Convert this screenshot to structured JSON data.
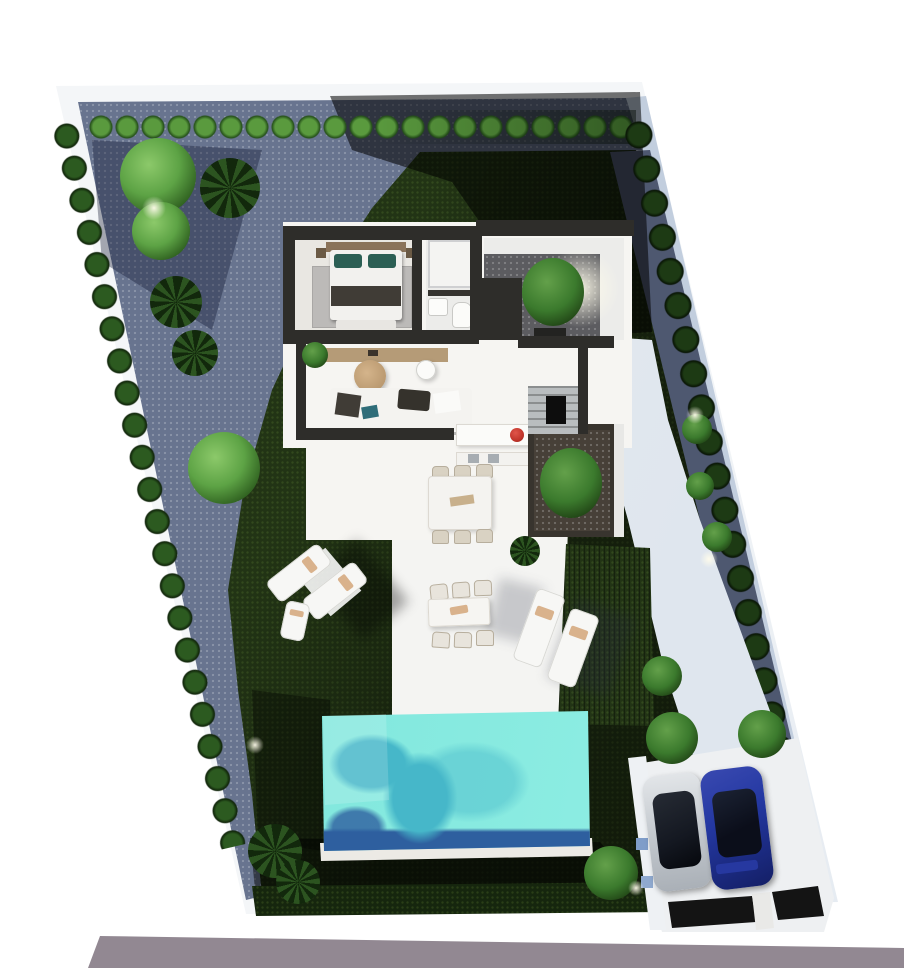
{
  "scene": {
    "title": "Aerial 3D site plan render of a modern villa plot",
    "type": "architectural-render",
    "no_text_visible": true
  },
  "colors": {
    "lawn": "#223415",
    "lawndark": "#0d1808",
    "hedgestrip": "#16260e",
    "gravel": "#68748f",
    "graveldark": "#4e5870",
    "wall": "#f1f4f7",
    "wallshade": "#c2cede",
    "terrace": "#f4f4f2",
    "pathwhite": "#edeff2",
    "pool": "#85e9df",
    "poollight": "#97f2e7",
    "poolmottle": "#46b7c9",
    "pooldeep": "#2e5f9f",
    "coping": "#eceae5",
    "roof": "#2e2d2a",
    "floor": "#f6f5f2",
    "floordim": "#e9e7e2",
    "rug": "#bcbab8",
    "wood": "#b59b77",
    "wooddark": "#8a735a",
    "tealpillow": "#2c5f54",
    "sofateal": "#2f6d79",
    "sofawhite": "#f4f3f0",
    "cushiondark": "#403c36",
    "redpot": "#c1352b",
    "chairbeige": "#d9d2c3",
    "courtyardgravel": "#5c5c60",
    "plantersoil": "#474038",
    "stair": "#b9bdbf",
    "driveway": "#caced2",
    "drivewaylight": "#eef0f2",
    "carsilver": "#c9ced3",
    "carsilverlight": "#e2e5e8",
    "carblue": "#2438a2",
    "carbluedark": "#141f66",
    "glass": "#141821",
    "gate": "#141414",
    "sidewalk": "#d9d2ca",
    "road": "#9d939b",
    "treebright": "#5da345",
    "treemid": "#3b7a2d"
  },
  "objects": [
    {
      "name": "plot-boundary-wall",
      "description": "white perimeter wall, skewed parallelogram plot"
    },
    {
      "name": "lawn",
      "description": "dark green grass covering most of the garden"
    },
    {
      "name": "gravel-garden",
      "description": "blue-grey gravel zone along top-left with trees and palms"
    },
    {
      "name": "hedge-rows",
      "description": "rows of round clipped shrubs along all boundaries"
    },
    {
      "name": "villa",
      "description": "single-storey white villa with flat dark roofline"
    },
    {
      "name": "bedroom",
      "description": "double bed, teal pillows, grey rug, bedside tables"
    },
    {
      "name": "bathroom",
      "description": "shower, washbasin and toilet"
    },
    {
      "name": "entry-courtyard",
      "description": "gravel patio with tree and warm uplight"
    },
    {
      "name": "living-room",
      "description": "white sofa, round wooden coffee table, floor lamp, sideboard"
    },
    {
      "name": "kitchen",
      "description": "island with red pot, counter with twin sinks"
    },
    {
      "name": "dining-table-indoor",
      "description": "white table with six beige chairs"
    },
    {
      "name": "staircase",
      "description": "grey stairs beside hallway"
    },
    {
      "name": "planter-bed",
      "description": "dark soil planter with large shrub beside kitchen"
    },
    {
      "name": "terrace",
      "description": "white paved terrace with loungers and outdoor dining set"
    },
    {
      "name": "sun-loungers",
      "description": "two pairs of white sun loungers"
    },
    {
      "name": "pool",
      "description": "turquoise rectangular swimming pool with dark deep-end edge"
    },
    {
      "name": "driveway",
      "description": "concrete parking pad with two parked cars"
    },
    {
      "name": "car-silver",
      "description": "silver car with dark glass roof"
    },
    {
      "name": "car-blue",
      "description": "blue car with dark glass roof"
    },
    {
      "name": "gate",
      "description": "dark entrance gate strips at the street"
    },
    {
      "name": "sidewalk",
      "description": "beige paver sidewalk along the street"
    },
    {
      "name": "road",
      "description": "grey asphalt road at the bottom"
    }
  ]
}
